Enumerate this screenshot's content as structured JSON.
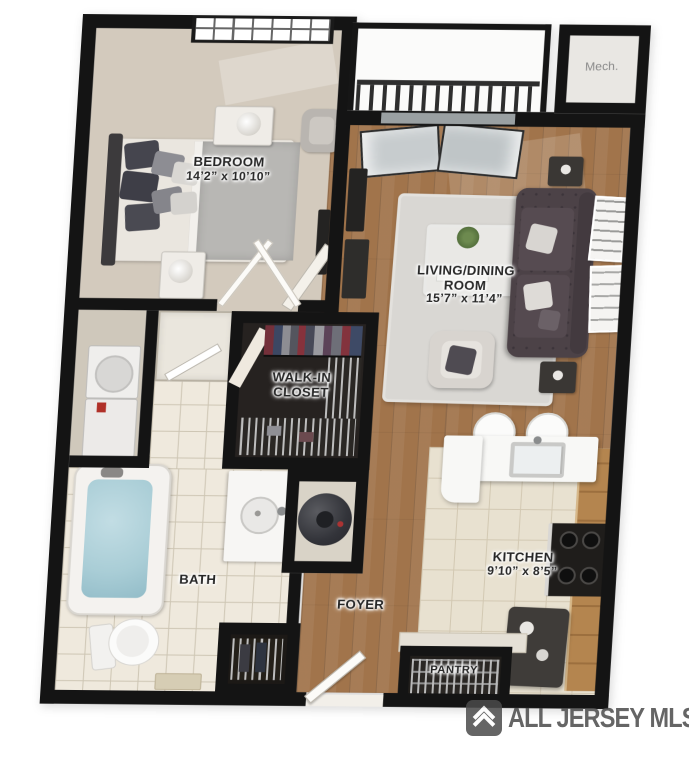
{
  "rooms": {
    "bedroom": {
      "line1": "BEDROOM",
      "dims": "14’2” x 10’10”"
    },
    "living": {
      "line1": "LIVING/DINING",
      "line2": "ROOM",
      "dims": "15’7” x 11’4”"
    },
    "walkin": {
      "line1": "WALK-IN",
      "line2": "CLOSET"
    },
    "bath": {
      "line1": "BATH"
    },
    "foyer": {
      "line1": "FOYER"
    },
    "kitchen": {
      "line1": "KITCHEN",
      "dims": "9’10” x 8’5”"
    },
    "pantry": {
      "line1": "PANTRY"
    },
    "mech": {
      "line1": "Mech."
    }
  },
  "watermark": {
    "text": "ALL JERSEY MLS",
    "logo": "chevron-house-icon"
  },
  "colors": {
    "wall": "#141414",
    "wood_floor": "#a1744b",
    "bath_tile": "#efe9dd",
    "kitchen_tile": "#e8e1d0",
    "bedroom_carpet": "#d3cabd",
    "rug": "#d9d7d3",
    "sofa": "#4c4247",
    "tub_water": "#a9cdd6",
    "cabinet_wood": "#b4854f",
    "watermark_gray": "#4b4b4b"
  }
}
